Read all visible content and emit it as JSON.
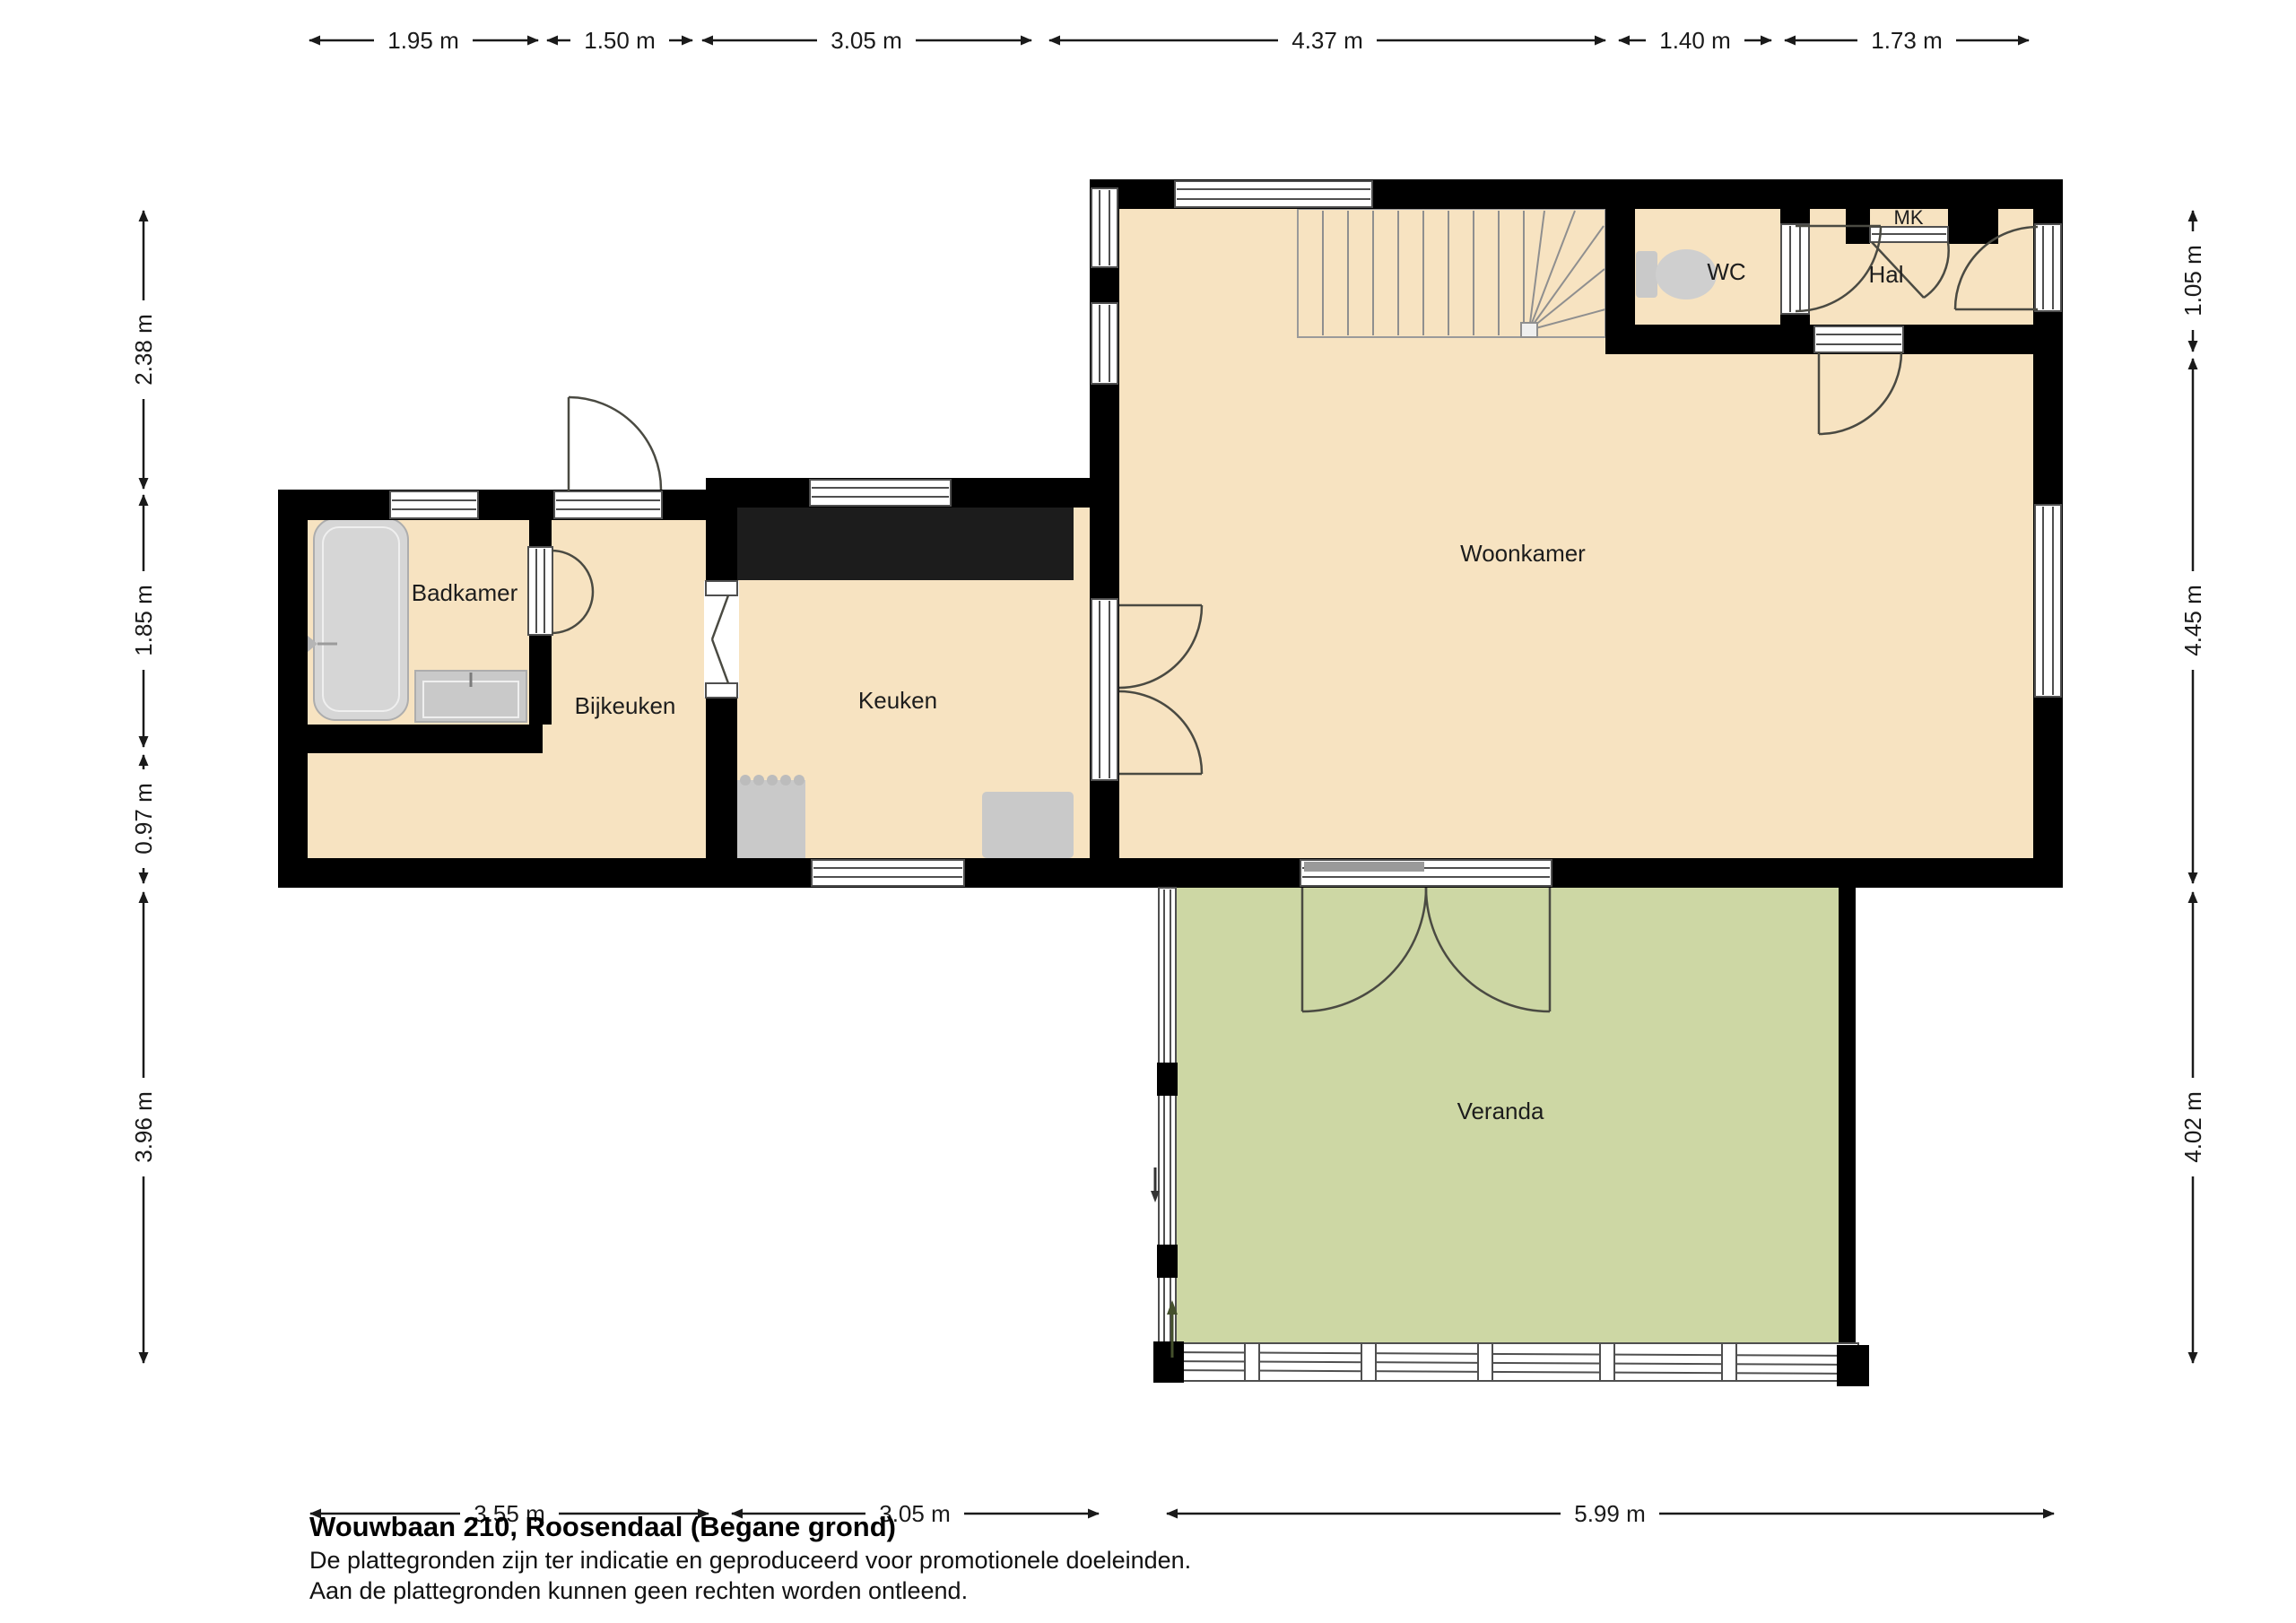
{
  "footer": {
    "title": "Wouwbaan 210, Roosendaal (Begane grond)",
    "line1": "De plattegronden zijn ter indicatie en geproduceerd voor promotionele doeleinden.",
    "line2": "Aan de plattegronden kunnen geen rechten worden ontleend."
  },
  "rooms": {
    "badkamer": "Badkamer",
    "bijkeuken": "Bijkeuken",
    "keuken": "Keuken",
    "woonkamer": "Woonkamer",
    "wc": "WC",
    "hal": "Hal",
    "mk": "MK",
    "veranda": "Veranda"
  },
  "dims": {
    "top": [
      "1.95 m",
      "1.50 m",
      "3.05 m",
      "4.37 m",
      "1.40 m",
      "1.73 m"
    ],
    "left": [
      "2.38 m",
      "1.85 m",
      "0.97 m",
      "3.96 m"
    ],
    "right": [
      "1.05 m",
      "4.45 m",
      "4.02 m"
    ],
    "bottom": [
      "3.55 m",
      "3.05 m",
      "5.99 m"
    ]
  },
  "colors": {
    "wall": "#000000",
    "floor": "#f7e3c1",
    "veranda": "#cdd7a4",
    "stairs": "#dcdcdc",
    "fixture": "#c9c9c9",
    "bath": "#d6d6d6",
    "counter": "#1c1c1c",
    "window_line": "#4f4f4f",
    "door_line": "#4a4a42",
    "dimension": "#1a1a1a",
    "veranda_arrow": "#44502c"
  }
}
